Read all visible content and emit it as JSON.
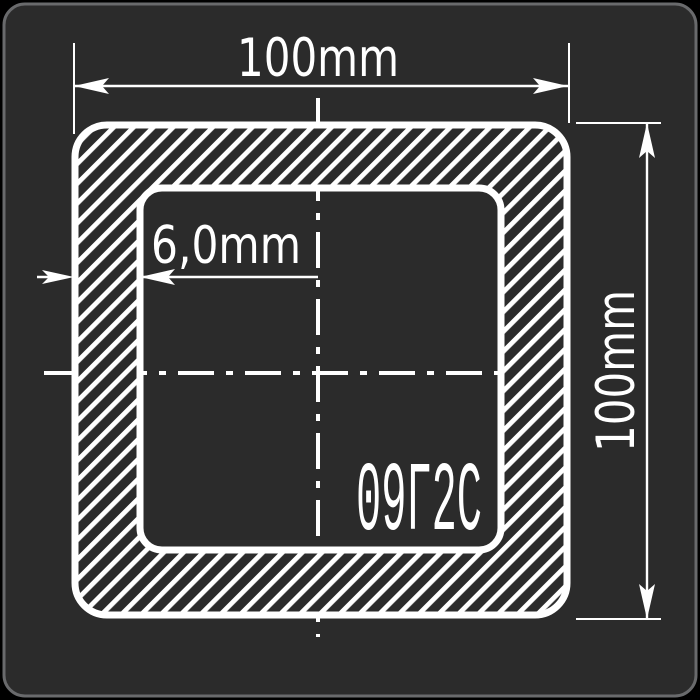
{
  "drawing": {
    "type": "square-tube-cross-section",
    "dimensions": {
      "outer_width": {
        "label": "100mm",
        "value": 100,
        "unit": "mm"
      },
      "outer_height": {
        "label": "100mm",
        "value": 100,
        "unit": "mm"
      },
      "wall_thickness": {
        "label": "6,0mm",
        "value": 6.0,
        "unit": "mm"
      }
    },
    "material": {
      "grade_label": "09Г2С"
    },
    "colors": {
      "background": "#000000",
      "panel": "#2b2b2b",
      "panel_border": "#696a6c",
      "line": "#ffffff"
    }
  }
}
